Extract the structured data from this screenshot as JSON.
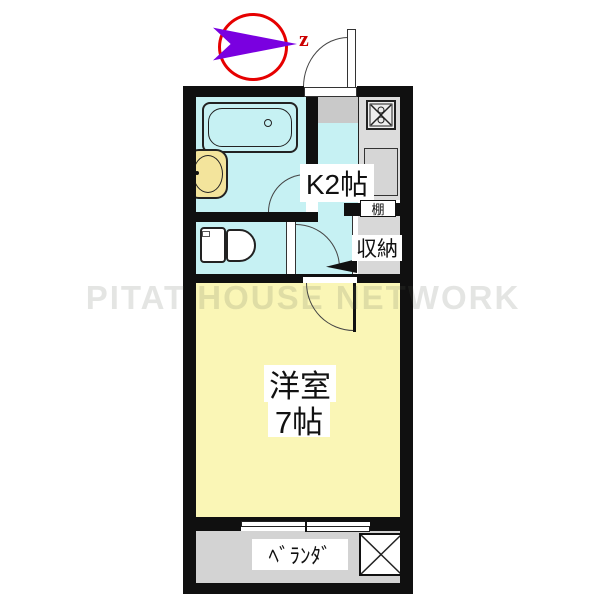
{
  "watermark": {
    "text": "PITAT HOUSE NETWORK"
  },
  "compass": {
    "north_label": "z"
  },
  "rooms": {
    "kitchen": {
      "label": "K2帖"
    },
    "shelf": {
      "label": "棚"
    },
    "closet": {
      "label": "収納"
    },
    "main": {
      "line1": "洋室",
      "line2": "7帖"
    },
    "veranda": {
      "label": "ﾍﾞﾗﾝﾀﾞ"
    }
  },
  "colors": {
    "wall": "#101010",
    "cyan": "#c6f1f3",
    "yellow": "#faf6b6",
    "veranda": "#d3d3d3",
    "counter": "#dcdcdc",
    "genkan": "#c9c9c9",
    "closet": "#d8d8d8",
    "sink": "#d6d6d6",
    "basin": "#f3e49c",
    "red": "#e60000",
    "purple": "#7a00e0",
    "north": "#cc0000"
  }
}
